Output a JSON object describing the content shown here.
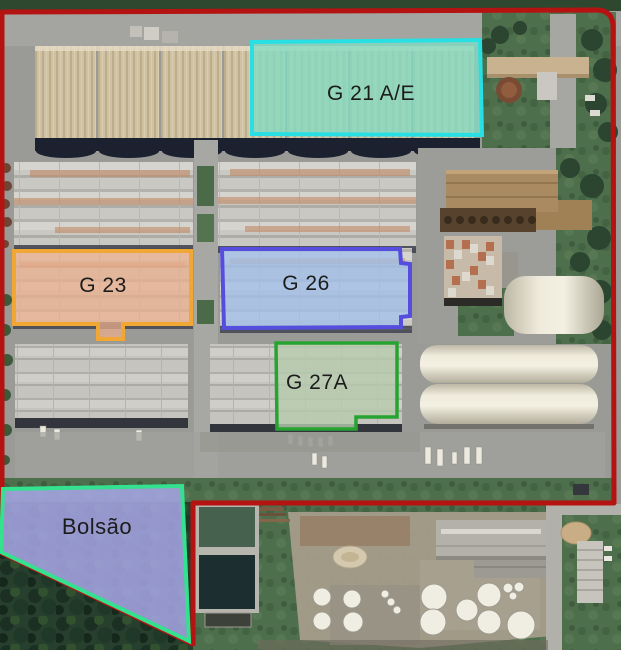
{
  "boundary": {
    "color": "#B51311"
  },
  "labels": {
    "color": "#1C1C1C"
  },
  "regions": [
    {
      "id": "g21ae",
      "label": "G 21 A/E",
      "fill": "#82DCC4",
      "border": "#28DFE3"
    },
    {
      "id": "g23",
      "label": "G 23",
      "fill": "#ECAE8C",
      "border": "#F0A733"
    },
    {
      "id": "g26",
      "label": "G 26",
      "fill": "#A2BFE9",
      "border": "#554DDE"
    },
    {
      "id": "g27a",
      "label": "G 27A",
      "fill": "#B5CCAE",
      "border": "#27A331"
    },
    {
      "id": "bolsao",
      "label": "Bolsão",
      "fill": "#A5A4E3",
      "border": "#33E18E"
    }
  ]
}
